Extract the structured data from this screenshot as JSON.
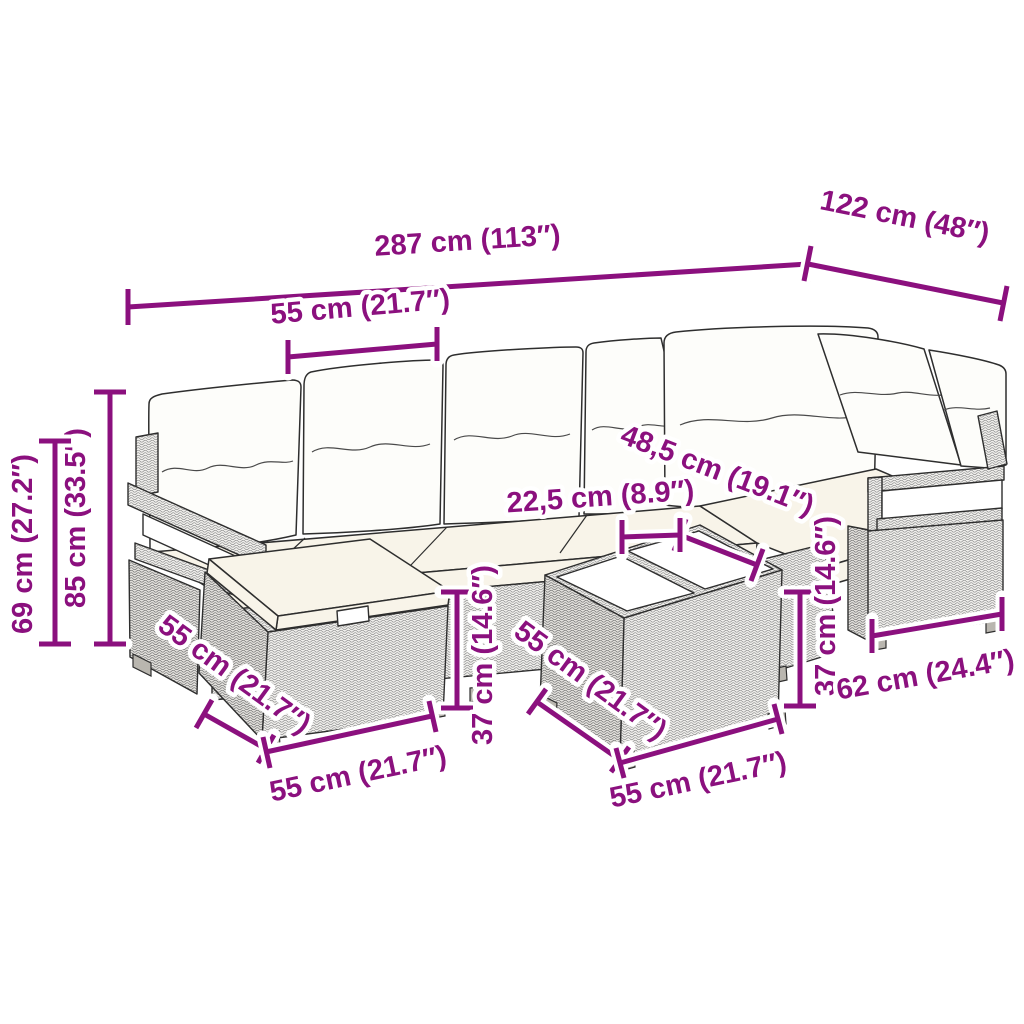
{
  "figure": {
    "title": "Rattan garden lounge set dimension diagram",
    "background": "#ffffff"
  },
  "style": {
    "dimension_color": "#8B107E",
    "outline_color": "#2e2e2e",
    "cushion_color": "#f8f4e9",
    "pillow_color": "#fdfdfa"
  },
  "dimensions": {
    "overall_width": "287 cm (113″)",
    "overall_depth": "122 cm (48″)",
    "seat_module_width": "55 cm (21.7″)",
    "total_height": "85 cm (33.5″)",
    "back_height": "69 cm (27.2″)",
    "seat_depth": "48,5 cm (19.1″)",
    "tray_width": "22,5 cm (8.9″)",
    "table_height": "37 cm (14.6″)",
    "ottoman_side_depth": "55 cm (21.7″)",
    "ottoman_front_width": "55 cm (21.7″)",
    "table_side_depth": "55 cm (21.7″)",
    "table_front_width": "55 cm (21.7″)",
    "stool_height": "37 cm (14.6″)",
    "armrest_section_width": "62 cm (24.4″)"
  }
}
